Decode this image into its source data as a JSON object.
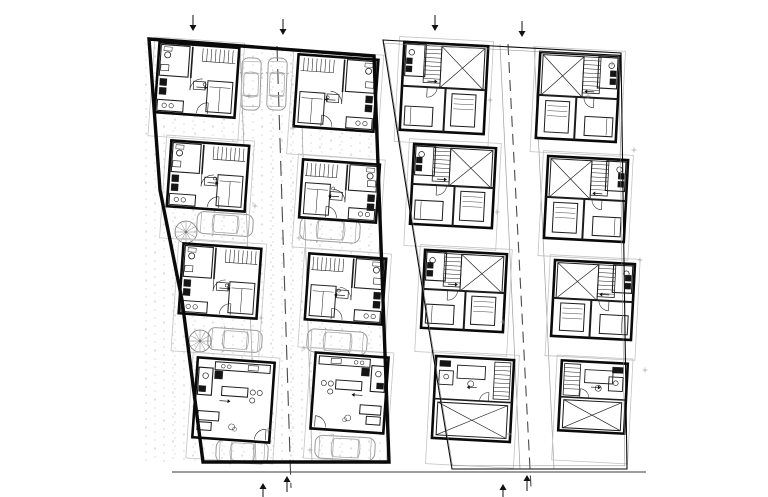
{
  "canvas": {
    "width": 768,
    "height": 497,
    "background": "#ffffff"
  },
  "palette": {
    "ink": "#0a0a0a",
    "furniture": "#1c1c1c",
    "fixture_fill": "#151515",
    "light_line": "#bdbdbd",
    "yard_line": "#c4c4c4",
    "car_line": "#9b9b9b",
    "drive_edge": "#9e9e9e",
    "stipple": "#cacaca",
    "centerline": "#4a4a4a",
    "ground_line": "#3a3a3a",
    "mark": "#9a9a9a"
  },
  "ground_line": {
    "x1": 172,
    "y1": 472,
    "x2": 646,
    "y2": 472
  },
  "plans": [
    {
      "id": "ground-floor-site-plan",
      "kind": "ground",
      "stipple": true,
      "boundary": [
        [
          149,
          39
        ],
        [
          374,
          56
        ],
        [
          389,
          462
        ],
        [
          203,
          462
        ],
        [
          182,
          300
        ],
        [
          160,
          190
        ]
      ],
      "boundary_width": 3.4,
      "centerline": {
        "x1": 277,
        "y1": 46,
        "x2": 291,
        "y2": 488,
        "dash": "15 8"
      },
      "drive_edges": [
        {
          "x1": 240,
          "y1": 46,
          "x2": 256,
          "y2": 462
        },
        {
          "x1": 300,
          "y1": 52,
          "x2": 312,
          "y2": 462
        }
      ],
      "units": [
        {
          "id": "L1",
          "x": 157,
          "y": 45,
          "w": 80,
          "h": 70,
          "rot": 4,
          "variant": "ground-a",
          "ext": 24
        },
        {
          "id": "L2",
          "x": 169,
          "y": 143,
          "w": 78,
          "h": 66,
          "rot": 4,
          "variant": "ground-a",
          "ext": 32
        },
        {
          "id": "L3",
          "x": 181,
          "y": 246,
          "w": 78,
          "h": 70,
          "rot": 4,
          "variant": "ground-a",
          "ext": 38
        },
        {
          "id": "L4",
          "x": 195,
          "y": 360,
          "w": 77,
          "h": 80,
          "rot": 4,
          "variant": "ground-living",
          "ext": 21
        },
        {
          "id": "R1",
          "x": 296,
          "y": 57,
          "w": 80,
          "h": 72,
          "rot": 4,
          "variant": "ground-b",
          "ext": 28
        },
        {
          "id": "R2",
          "x": 301,
          "y": 162,
          "w": 77,
          "h": 58,
          "rot": 4,
          "variant": "ground-b",
          "ext": 30
        },
        {
          "id": "R3",
          "x": 307,
          "y": 256,
          "w": 77,
          "h": 66,
          "rot": 4,
          "variant": "ground-b",
          "ext": 28
        },
        {
          "id": "R4",
          "x": 313,
          "y": 355,
          "w": 73,
          "h": 76,
          "rot": 4,
          "variant": "ground-living-m",
          "ext": 30
        }
      ],
      "cars": [
        {
          "cx": 251,
          "cy": 84,
          "len": 52,
          "wid": 19,
          "rot": 92
        },
        {
          "cx": 277,
          "cy": 84,
          "len": 52,
          "wid": 19,
          "rot": 92
        },
        {
          "cx": 225,
          "cy": 224,
          "len": 56,
          "wid": 22,
          "rot": 4
        },
        {
          "cx": 330,
          "cy": 230,
          "len": 60,
          "wid": 23,
          "rot": 4
        },
        {
          "cx": 235,
          "cy": 340,
          "len": 54,
          "wid": 22,
          "rot": 4
        },
        {
          "cx": 337,
          "cy": 342,
          "len": 60,
          "wid": 23,
          "rot": 4
        },
        {
          "cx": 242,
          "cy": 452,
          "len": 52,
          "wid": 22,
          "rot": 3
        },
        {
          "cx": 345,
          "cy": 448,
          "len": 60,
          "wid": 23,
          "rot": 3
        }
      ],
      "spiral_stairs": [
        {
          "cx": 186,
          "cy": 232,
          "r": 11
        },
        {
          "cx": 200,
          "cy": 341,
          "r": 11
        }
      ],
      "markers_top": [
        {
          "x": 193,
          "y": 27
        },
        {
          "x": 283,
          "y": 31
        }
      ],
      "markers_bottom": [
        {
          "x": 263,
          "y": 487
        },
        {
          "x": 287,
          "y": 480
        }
      ],
      "level_marks": [
        [
          249,
          96
        ],
        [
          255,
          206
        ],
        [
          261,
          318
        ],
        [
          268,
          430
        ],
        [
          293,
          128
        ],
        [
          299,
          238
        ],
        [
          304,
          348
        ],
        [
          310,
          450
        ]
      ]
    },
    {
      "id": "upper-floor-plan",
      "kind": "upper",
      "stipple": false,
      "boundary": [
        [
          383,
          40
        ],
        [
          621,
          53
        ],
        [
          627,
          469
        ],
        [
          452,
          469
        ],
        [
          429,
          330
        ],
        [
          405,
          180
        ]
      ],
      "boundary_width": 1.1,
      "centerline": {
        "x1": 508,
        "y1": 44,
        "x2": 531,
        "y2": 488,
        "dash": "11 7"
      },
      "drive_edges": [
        {
          "x1": 500,
          "y1": 44,
          "x2": 520,
          "y2": 469
        },
        {
          "x1": 534,
          "y1": 46,
          "x2": 554,
          "y2": 469
        }
      ],
      "units": [
        {
          "id": "UL1",
          "x": 402,
          "y": 44,
          "w": 84,
          "h": 88,
          "rot": 3,
          "variant": "upper-a",
          "ext": 12
        },
        {
          "id": "UL2",
          "x": 412,
          "y": 146,
          "w": 82,
          "h": 80,
          "rot": 3,
          "variant": "upper-a",
          "ext": 22
        },
        {
          "id": "UL3",
          "x": 423,
          "y": 252,
          "w": 82,
          "h": 78,
          "rot": 3,
          "variant": "upper-a",
          "ext": 24
        },
        {
          "id": "UL4",
          "x": 434,
          "y": 358,
          "w": 78,
          "h": 82,
          "rot": 3,
          "variant": "upper-c-m",
          "ext": 26
        },
        {
          "id": "UR1",
          "x": 538,
          "y": 54,
          "w": 80,
          "h": 86,
          "rot": 3,
          "variant": "upper-b",
          "ext": 14
        },
        {
          "id": "UR2",
          "x": 546,
          "y": 158,
          "w": 80,
          "h": 82,
          "rot": 3,
          "variant": "upper-b",
          "ext": 18
        },
        {
          "id": "UR3",
          "x": 553,
          "y": 262,
          "w": 80,
          "h": 76,
          "rot": 3,
          "variant": "upper-b",
          "ext": 20
        },
        {
          "id": "UR4",
          "x": 560,
          "y": 362,
          "w": 66,
          "h": 70,
          "rot": 3,
          "variant": "upper-c",
          "ext": 30
        }
      ],
      "cars": [],
      "spiral_stairs": [],
      "markers_top": [
        {
          "x": 435,
          "y": 27
        },
        {
          "x": 522,
          "y": 33
        }
      ],
      "markers_bottom": [
        {
          "x": 503,
          "y": 488
        },
        {
          "x": 527,
          "y": 479
        }
      ],
      "level_marks": [
        [
          490,
          100
        ],
        [
          497,
          212
        ],
        [
          503,
          322
        ],
        [
          509,
          434
        ],
        [
          588,
          96
        ],
        [
          634,
          150
        ],
        [
          640,
          260
        ],
        [
          645,
          370
        ],
        [
          612,
          64
        ]
      ]
    }
  ]
}
